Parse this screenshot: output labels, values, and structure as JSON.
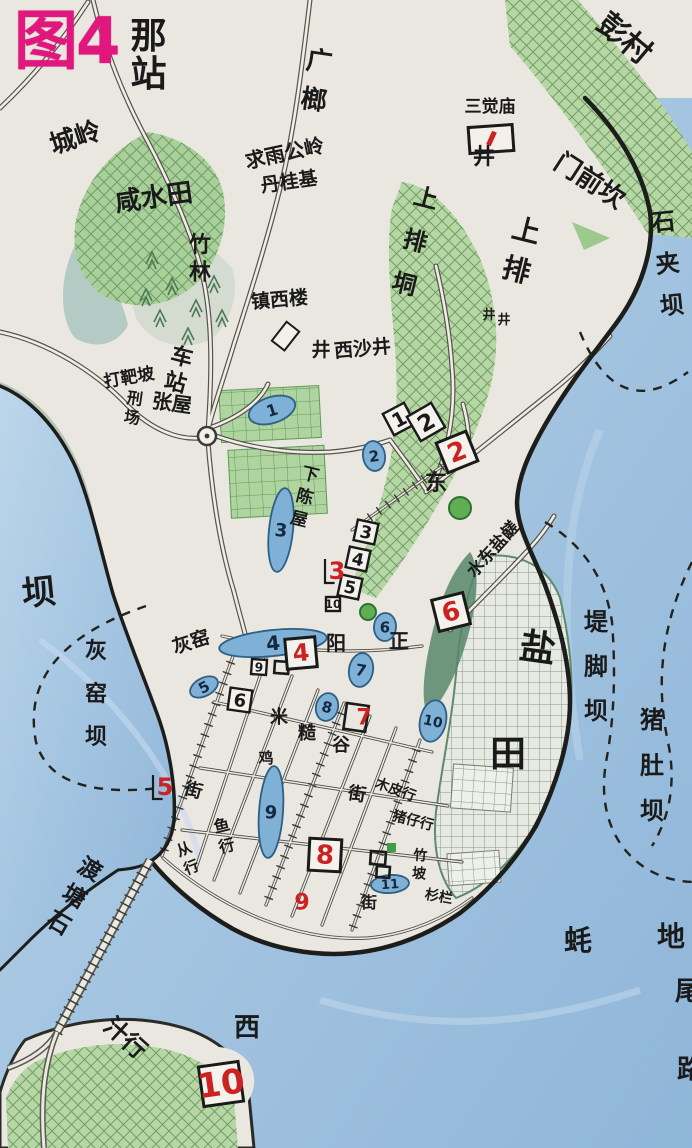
{
  "title": {
    "figure": "图4",
    "station": "那站"
  },
  "colors": {
    "accent_magenta": "#e0187e",
    "red_mark": "#cc2222",
    "water": "#a9c7e2",
    "field_green": "#b7d6a6",
    "pond_blue": "#7fb0d6",
    "ink": "#1a1a1a"
  },
  "labels": [
    {
      "t": "城岭",
      "x": 78,
      "y": 146,
      "s": 26,
      "rot": -18
    },
    {
      "t": "咸水田",
      "x": 155,
      "y": 206,
      "s": 26,
      "rot": -8
    },
    {
      "t": "竹林",
      "x": 200,
      "y": 252,
      "s": 22,
      "v": 1,
      "gap": 1.25
    },
    {
      "t": "广榔",
      "x": 318,
      "y": 70,
      "s": 26,
      "v": 1,
      "rot": 8,
      "gap": 1.5
    },
    {
      "t": "求雨公岭",
      "x": 286,
      "y": 160,
      "s": 20,
      "rot": -12
    },
    {
      "t": "丹桂基",
      "x": 290,
      "y": 188,
      "s": 19,
      "rot": -8
    },
    {
      "t": "三觉庙",
      "x": 490,
      "y": 112,
      "s": 17
    },
    {
      "t": "彭村",
      "x": 618,
      "y": 46,
      "s": 30,
      "rot": 40
    },
    {
      "t": "门前坎",
      "x": 585,
      "y": 188,
      "s": 26,
      "rot": 33
    },
    {
      "t": "上排",
      "x": 524,
      "y": 240,
      "s": 28,
      "v": 1,
      "rot": 14,
      "gap": 1.45
    },
    {
      "t": "上排垌",
      "x": 424,
      "y": 206,
      "s": 24,
      "v": 1,
      "rot": 14,
      "gap": 1.85
    },
    {
      "t": "石夹坝",
      "x": 664,
      "y": 230,
      "s": 24,
      "v": 1,
      "rot": -6,
      "gap": 1.75
    },
    {
      "t": "镇西楼",
      "x": 280,
      "y": 306,
      "s": 19,
      "rot": -5
    },
    {
      "t": "西沙井",
      "x": 363,
      "y": 355,
      "s": 19,
      "rot": -5
    },
    {
      "t": "车站",
      "x": 180,
      "y": 364,
      "s": 22,
      "v": 1,
      "rot": 14,
      "gap": 1.2
    },
    {
      "t": "张屋",
      "x": 171,
      "y": 410,
      "s": 20,
      "rot": 8
    },
    {
      "t": "打靶坡",
      "x": 130,
      "y": 383,
      "s": 17,
      "rot": -10
    },
    {
      "t": "刑场",
      "x": 134,
      "y": 404,
      "s": 16,
      "v": 1,
      "rot": 8,
      "gap": 1.2
    },
    {
      "t": "下陈屋",
      "x": 309,
      "y": 480,
      "s": 17,
      "v": 1,
      "rot": 14,
      "gap": 1.35
    },
    {
      "t": "东",
      "x": 436,
      "y": 490,
      "s": 22
    },
    {
      "t": "水东盐鹾",
      "x": 497,
      "y": 553,
      "s": 17,
      "rot": -48
    },
    {
      "t": "盐",
      "x": 536,
      "y": 660,
      "s": 36,
      "rot": 8
    },
    {
      "t": "田",
      "x": 508,
      "y": 766,
      "s": 36
    },
    {
      "t": "堤脚坝",
      "x": 596,
      "y": 630,
      "s": 24,
      "v": 1,
      "gap": 1.85
    },
    {
      "t": "猪肚坝",
      "x": 652,
      "y": 728,
      "s": 24,
      "v": 1,
      "gap": 1.9
    },
    {
      "t": "坝",
      "x": 40,
      "y": 604,
      "s": 34,
      "rot": -6
    },
    {
      "t": "灰窑坝",
      "x": 96,
      "y": 658,
      "s": 22,
      "v": 1,
      "gap": 1.95
    },
    {
      "t": "灰窑",
      "x": 193,
      "y": 648,
      "s": 19,
      "rot": -18
    },
    {
      "t": "阳",
      "x": 336,
      "y": 650,
      "s": 20
    },
    {
      "t": "正",
      "x": 399,
      "y": 648,
      "s": 20
    },
    {
      "t": "米",
      "x": 279,
      "y": 723,
      "s": 18
    },
    {
      "t": "糙",
      "x": 307,
      "y": 739,
      "s": 18
    },
    {
      "t": "谷",
      "x": 341,
      "y": 751,
      "s": 18
    },
    {
      "t": "街",
      "x": 356,
      "y": 800,
      "s": 18,
      "rot": 10
    },
    {
      "t": "街",
      "x": 192,
      "y": 796,
      "s": 18,
      "rot": 15
    },
    {
      "t": "街",
      "x": 369,
      "y": 908,
      "s": 16
    },
    {
      "t": "鸡",
      "x": 266,
      "y": 763,
      "s": 15
    },
    {
      "t": "鱼行",
      "x": 223,
      "y": 831,
      "s": 16,
      "v": 1,
      "rot": -14,
      "gap": 1.3
    },
    {
      "t": "从行",
      "x": 186,
      "y": 854,
      "s": 15,
      "v": 1,
      "rot": -22,
      "gap": 1.3
    },
    {
      "t": "木皮行",
      "x": 394,
      "y": 794,
      "s": 14,
      "rot": 20
    },
    {
      "t": "猪仔行",
      "x": 412,
      "y": 825,
      "s": 14,
      "rot": 14
    },
    {
      "t": "竹坡",
      "x": 420,
      "y": 860,
      "s": 14,
      "v": 1,
      "rot": 4,
      "gap": 1.3
    },
    {
      "t": "杉栏",
      "x": 438,
      "y": 901,
      "s": 14,
      "rot": 10
    },
    {
      "t": "石塘渡",
      "x": 86,
      "y": 876,
      "s": 23,
      "v": 1,
      "rot": 30,
      "rev": 1,
      "gap": 1.35
    },
    {
      "t": "汁行",
      "x": 120,
      "y": 1044,
      "s": 24,
      "rot": 42
    },
    {
      "t": "西",
      "x": 247,
      "y": 1036,
      "s": 26
    },
    {
      "t": "蚝",
      "x": 578,
      "y": 950,
      "s": 28
    },
    {
      "t": "地",
      "x": 671,
      "y": 946,
      "s": 28
    },
    {
      "t": "尾",
      "x": 688,
      "y": 1000,
      "s": 26
    },
    {
      "t": "路",
      "x": 690,
      "y": 1078,
      "s": 26
    }
  ],
  "wells": [
    {
      "x": 484,
      "y": 164,
      "s": 22
    },
    {
      "x": 489,
      "y": 319,
      "s": 13
    },
    {
      "x": 504,
      "y": 324,
      "s": 13
    },
    {
      "x": 321,
      "y": 356,
      "s": 19
    }
  ],
  "ponds": [
    {
      "n": "1",
      "x": 272,
      "y": 410,
      "rx": 24,
      "ry": 13,
      "rot": -18,
      "fs": 16
    },
    {
      "n": "2",
      "x": 374,
      "y": 456,
      "rx": 11,
      "ry": 15,
      "rot": -8,
      "fs": 15
    },
    {
      "n": "3",
      "x": 281,
      "y": 530,
      "rx": 12,
      "ry": 42,
      "rot": 6,
      "fs": 18
    },
    {
      "n": "4",
      "x": 273,
      "y": 643,
      "rx": 54,
      "ry": 13,
      "rot": -6,
      "fs": 20
    },
    {
      "n": "5",
      "x": 204,
      "y": 687,
      "rx": 15,
      "ry": 9,
      "rot": -28,
      "fs": 15
    },
    {
      "n": "6",
      "x": 385,
      "y": 627,
      "rx": 11,
      "ry": 14,
      "rot": 4,
      "fs": 15
    },
    {
      "n": "7",
      "x": 361,
      "y": 670,
      "rx": 12,
      "ry": 17,
      "rot": 10,
      "fs": 16
    },
    {
      "n": "8",
      "x": 327,
      "y": 707,
      "rx": 11,
      "ry": 14,
      "rot": 14,
      "fs": 15
    },
    {
      "n": "9",
      "x": 271,
      "y": 812,
      "rx": 12,
      "ry": 46,
      "rot": 4,
      "fs": 18
    },
    {
      "n": "10",
      "x": 433,
      "y": 721,
      "rx": 13,
      "ry": 21,
      "rot": 12,
      "fs": 14
    },
    {
      "n": "11",
      "x": 390,
      "y": 884,
      "rx": 19,
      "ry": 9,
      "rot": -4,
      "fs": 13
    }
  ],
  "site_boxes": [
    {
      "n": "1",
      "x": 399,
      "y": 419,
      "s": 24,
      "rot": -28
    },
    {
      "n": "2",
      "x": 426,
      "y": 422,
      "s": 28,
      "rot": -30
    },
    {
      "n": "3",
      "x": 366,
      "y": 532,
      "s": 21,
      "rot": 12
    },
    {
      "n": "4",
      "x": 358,
      "y": 559,
      "s": 21,
      "rot": 12
    },
    {
      "n": "5",
      "x": 350,
      "y": 587,
      "s": 21,
      "rot": 12
    },
    {
      "n": "9",
      "x": 259,
      "y": 667,
      "s": 15,
      "rot": 4
    },
    {
      "n": "6",
      "x": 240,
      "y": 700,
      "s": 22,
      "rot": 8
    },
    {
      "n": "10",
      "x": 333,
      "y": 604,
      "s": 14,
      "rot": 0
    }
  ],
  "red_sites": [
    {
      "n": "2",
      "x": 457,
      "y": 452,
      "s": 26,
      "rot": -22,
      "style": "boxed"
    },
    {
      "n": "3",
      "x": 337,
      "y": 571,
      "s": 24,
      "style": "bracket"
    },
    {
      "n": "4",
      "x": 301,
      "y": 653,
      "s": 24,
      "rot": -5,
      "style": "boxed"
    },
    {
      "n": "5",
      "x": 165,
      "y": 787,
      "s": 24,
      "style": "bracket"
    },
    {
      "n": "6",
      "x": 451,
      "y": 612,
      "s": 26,
      "rot": -14,
      "style": "boxed"
    },
    {
      "n": "7",
      "x": 364,
      "y": 717,
      "s": 22,
      "style": "plain"
    },
    {
      "n": "8",
      "x": 325,
      "y": 855,
      "s": 26,
      "rot": 3,
      "style": "boxed"
    },
    {
      "n": "9",
      "x": 302,
      "y": 902,
      "s": 22,
      "style": "plain"
    },
    {
      "n": "10",
      "x": 221,
      "y": 1084,
      "s": 34,
      "rot": -8,
      "style": "boxed"
    }
  ],
  "symbols": {
    "temple": {
      "x": 491,
      "y": 139,
      "w": 44,
      "h": 26,
      "rot": -4
    },
    "tower_rhombus": {
      "x": 288,
      "y": 333,
      "s": 16,
      "rot": 38
    },
    "roundabout": {
      "x": 207,
      "y": 436,
      "r": 9
    },
    "round_trees": [
      {
        "x": 460,
        "y": 508,
        "r": 11
      },
      {
        "x": 368,
        "y": 612,
        "r": 8
      }
    ],
    "pines": [
      [
        152,
        258
      ],
      [
        172,
        284
      ],
      [
        196,
        306
      ],
      [
        214,
        282
      ],
      [
        160,
        316
      ],
      [
        188,
        334
      ],
      [
        222,
        316
      ],
      [
        146,
        295
      ]
    ],
    "buildings": [
      [
        347,
        703,
        22,
        26,
        8
      ],
      [
        371,
        851,
        15,
        13,
        4
      ],
      [
        377,
        866,
        13,
        11,
        4
      ],
      [
        275,
        661,
        14,
        12,
        4
      ]
    ],
    "green_square": {
      "x": 387,
      "y": 843,
      "s": 9
    }
  }
}
